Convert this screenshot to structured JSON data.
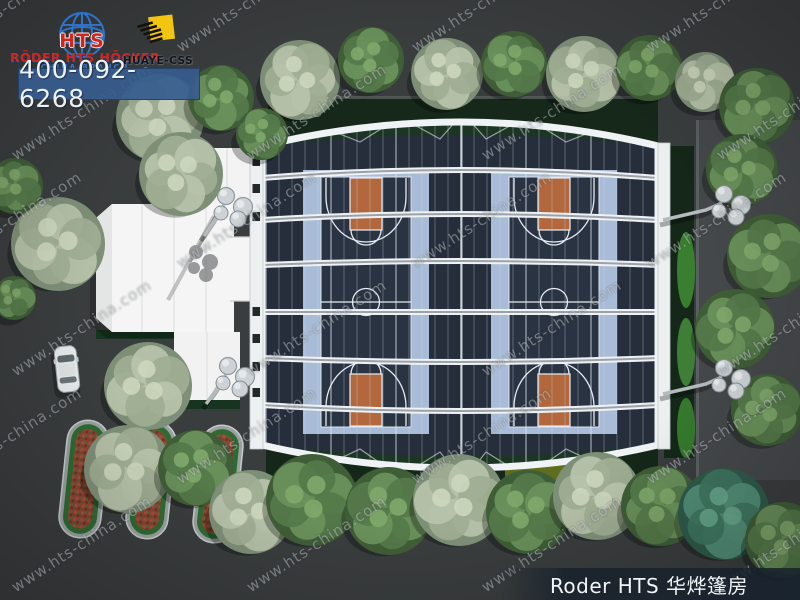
{
  "branding": {
    "logo": {
      "acronym": "HTS",
      "company": "RÖDER HTS HÖCKER",
      "branch": "CHINA BRANCH"
    },
    "partner_logo": {
      "label": "HUAYE-CSS"
    },
    "phone": "400-092-6268"
  },
  "caption": {
    "text": "Roder HTS 华烨篷房"
  },
  "watermark": {
    "text": "www.hts-china.com"
  },
  "icons": {
    "globe": "globe-icon",
    "partner_mark": "huaye-flag-icon"
  },
  "colors": {
    "phone_banner_blue": "#365c8e",
    "logo_red": "#cf2820",
    "logo_blue": "#2f7ad6",
    "partner_yellow": "#f2c511",
    "tent_frame_white": "#f0f3f5",
    "court_surface_navy": "#2a3342",
    "court_apron_blue": "#a9bcd7",
    "court_key_orange": "#b2683c",
    "hedge_green": "#16281a",
    "tree_green": "#55794a",
    "tree_sage": "#a3b29b",
    "ground_gray": "#3a3d3e",
    "caption_bg": "#18222d"
  }
}
